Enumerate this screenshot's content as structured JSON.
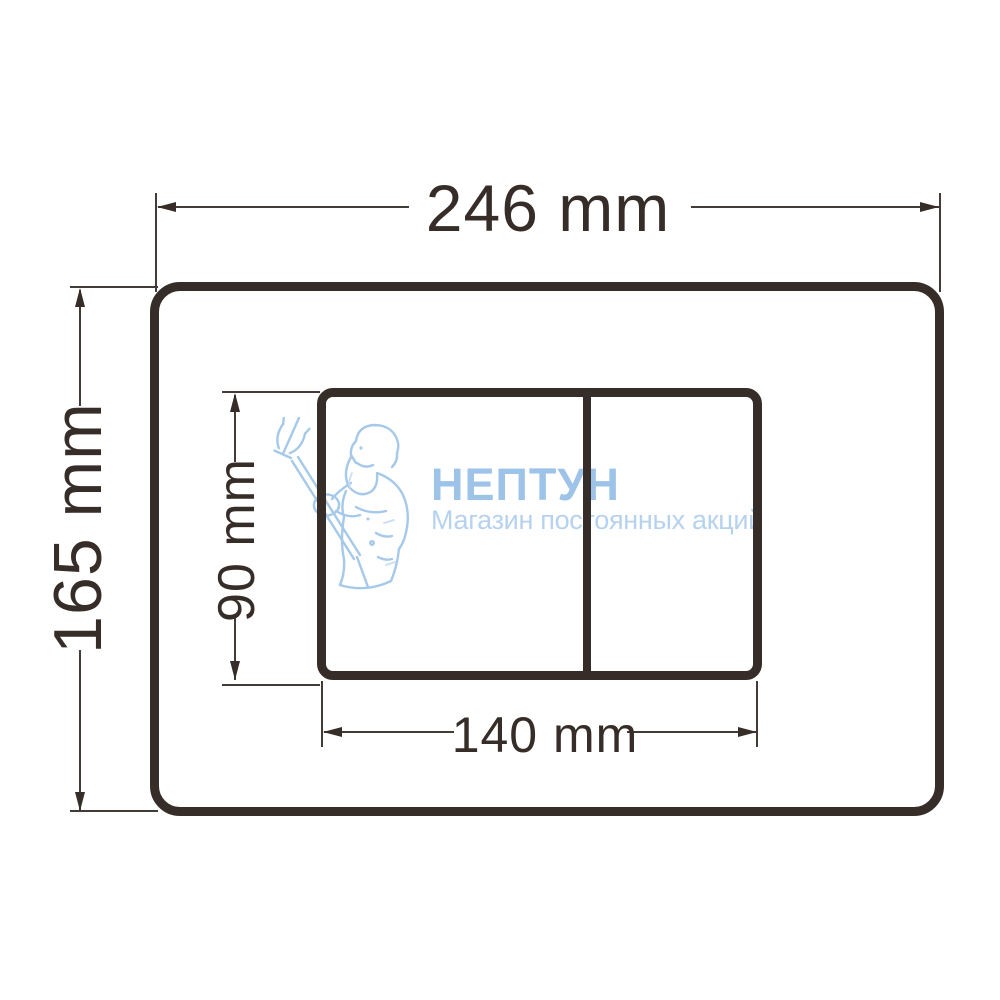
{
  "diagram": {
    "type": "technical-dimension-drawing",
    "subject": "dual-flush toilet plate front view",
    "line_color": "#362d28",
    "background": "#ffffff",
    "dimensions": {
      "plate_width_label": "246 mm",
      "plate_height_label": "165 mm",
      "button_area_width_label": "140 mm",
      "button_area_height_label": "90 mm"
    }
  },
  "watermark": {
    "title": "НЕПТУН",
    "subtitle": "Магазин постоянных акций",
    "title_color": "#9dc3e8",
    "subtitle_color": "#b6d2ee",
    "figure": "neptune-with-trident",
    "figure_color": "#a6c9ea"
  }
}
